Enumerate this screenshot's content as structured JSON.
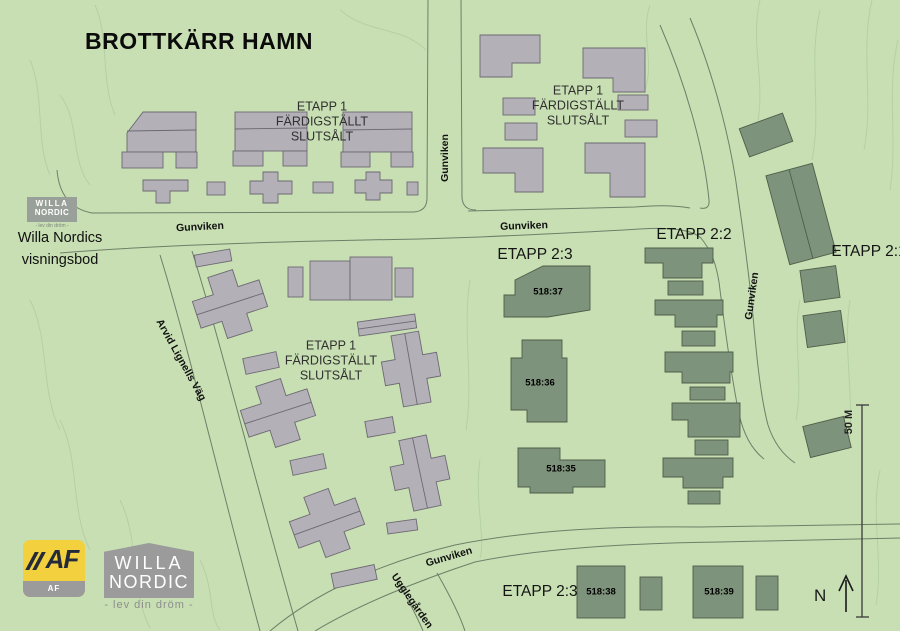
{
  "title": "BROTTKÄRR HAMN",
  "etapp1_label": {
    "line1": "ETAPP 1",
    "line2": "FÄRDIGSTÄLLT",
    "line3": "SLUTSÅLT"
  },
  "phase_labels": {
    "etapp_2_3": "ETAPP 2:3",
    "etapp_2_2": "ETAPP 2:2",
    "etapp_2_1": "ETAPP 2:1",
    "etapp_2_3_south": "ETAPP 2:3"
  },
  "plot_numbers": {
    "p518_37": "518:37",
    "p518_36": "518:36",
    "p518_35": "518:35",
    "p518_38": "518:38",
    "p518_39": "518:39"
  },
  "street_names": {
    "gunviken": "Gunviken",
    "arvid_lignells_vag": "Arvid Lignells Väg",
    "ugglegarden": "Ugglegården"
  },
  "visningsbod": {
    "line1": "Willa Nordics",
    "line2": "visningsbod"
  },
  "scale_bar": {
    "label": "50 M"
  },
  "compass": {
    "label": "N"
  },
  "logos": {
    "af_gruppen": {
      "monogram": "AF",
      "band": "AF GRUPPEN"
    },
    "willa_nordic": {
      "line1": "WILLA",
      "line2": "NORDIC",
      "tagline": "- lev din dröm -"
    },
    "willa_nordic_small": {
      "line1": "WILLA",
      "line2": "NORDIC",
      "tagline": "- lev din dröm -"
    }
  },
  "colors": {
    "background": "#c7dfb3",
    "gray_building": "#b4b0b8",
    "green_building": "#7e937b",
    "road_line": "#6e7f68",
    "contour_line": "#a6c497",
    "af_yellow": "#f2d03e",
    "logo_gray": "#9b9b9b"
  }
}
